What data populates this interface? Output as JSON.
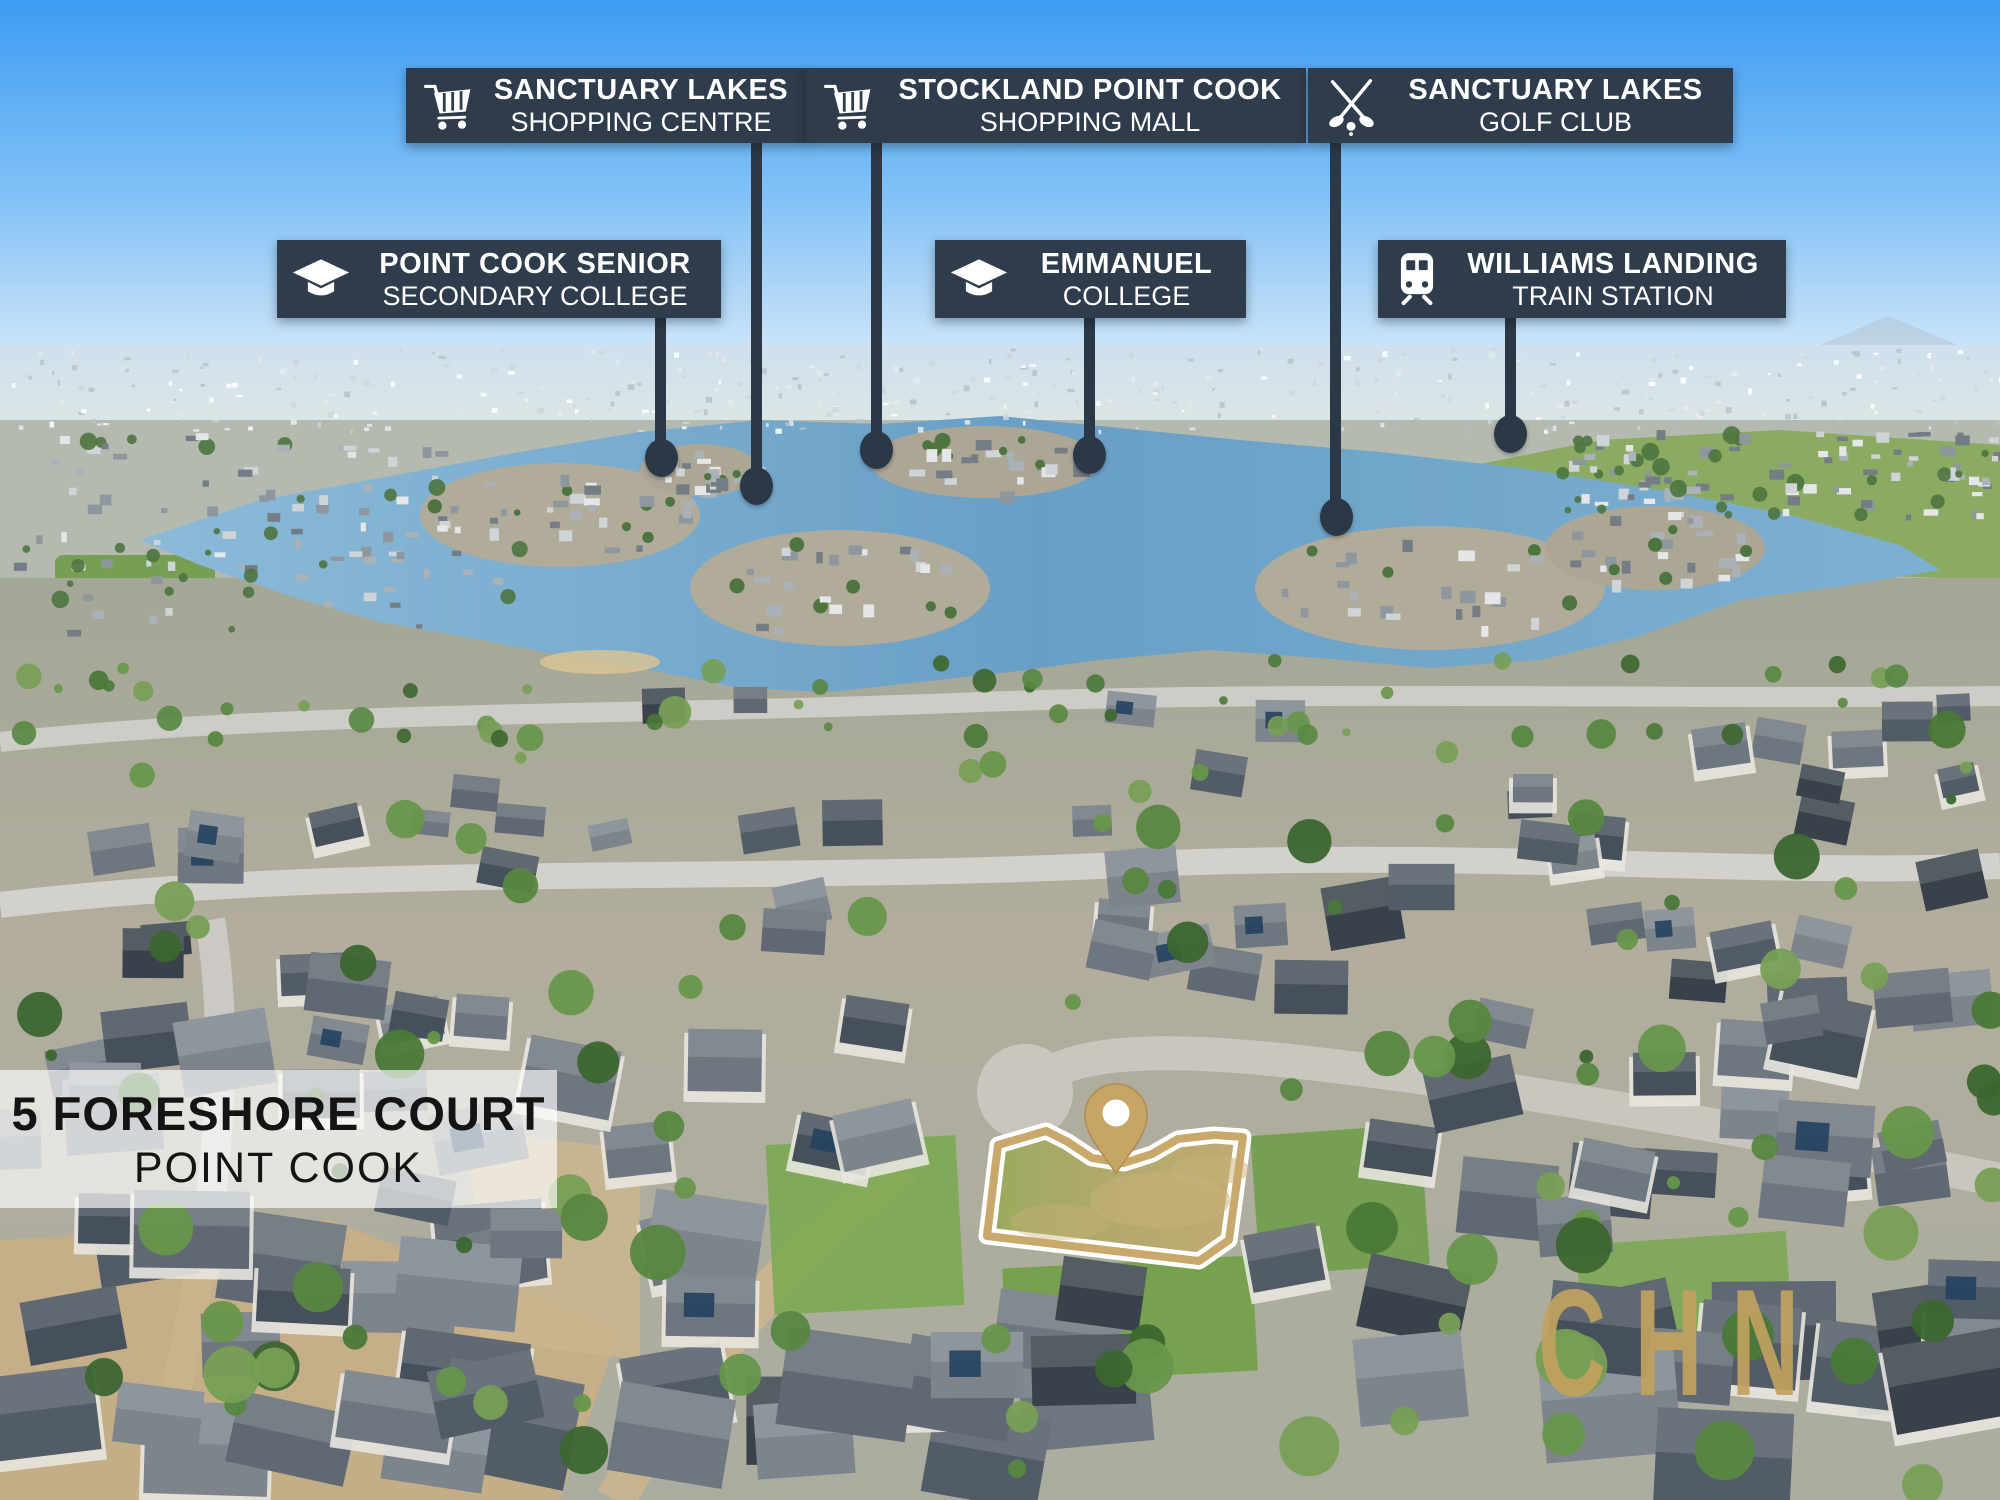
{
  "colors": {
    "label_background": "#2e3c4b",
    "label_text": "#ffffff",
    "leader_line": "#2b3845",
    "brand_gold": "#c7a566",
    "boundary_gold": "#c9a86b",
    "address_text": "#141414",
    "watermark_gold": "#c2a25f"
  },
  "callouts": [
    {
      "id": "sanctuary-lakes-shopping-centre",
      "icon": "shopping-cart-icon",
      "line1": "SANCTUARY LAKES",
      "line2": "SHOPPING CENTRE"
    },
    {
      "id": "stockland-point-cook-shopping-mall",
      "icon": "shopping-cart-icon",
      "line1": "STOCKLAND POINT COOK",
      "line2": "SHOPPING MALL"
    },
    {
      "id": "sanctuary-lakes-golf-club",
      "icon": "golf-clubs-icon",
      "line1": "SANCTUARY LAKES",
      "line2": "GOLF CLUB"
    },
    {
      "id": "point-cook-senior-secondary-college",
      "icon": "graduation-cap-icon",
      "line1": "POINT COOK SENIOR",
      "line2": "SECONDARY COLLEGE"
    },
    {
      "id": "emmanuel-college",
      "icon": "graduation-cap-icon",
      "line1": "EMMANUEL",
      "line2": "COLLEGE"
    },
    {
      "id": "williams-landing-train-station",
      "icon": "train-icon",
      "line1": "WILLIAMS LANDING",
      "line2": "TRAIN STATION"
    }
  ],
  "address": {
    "line1": "5 FORESHORE COURT",
    "line2": "POINT COOK"
  },
  "watermark": {
    "text": "CHN"
  },
  "property": {
    "pin_icon": "map-pin-icon",
    "boundary": "gold-outlined vacant lot polygon",
    "pin_position": {
      "x": 1116,
      "y": 1173
    }
  }
}
